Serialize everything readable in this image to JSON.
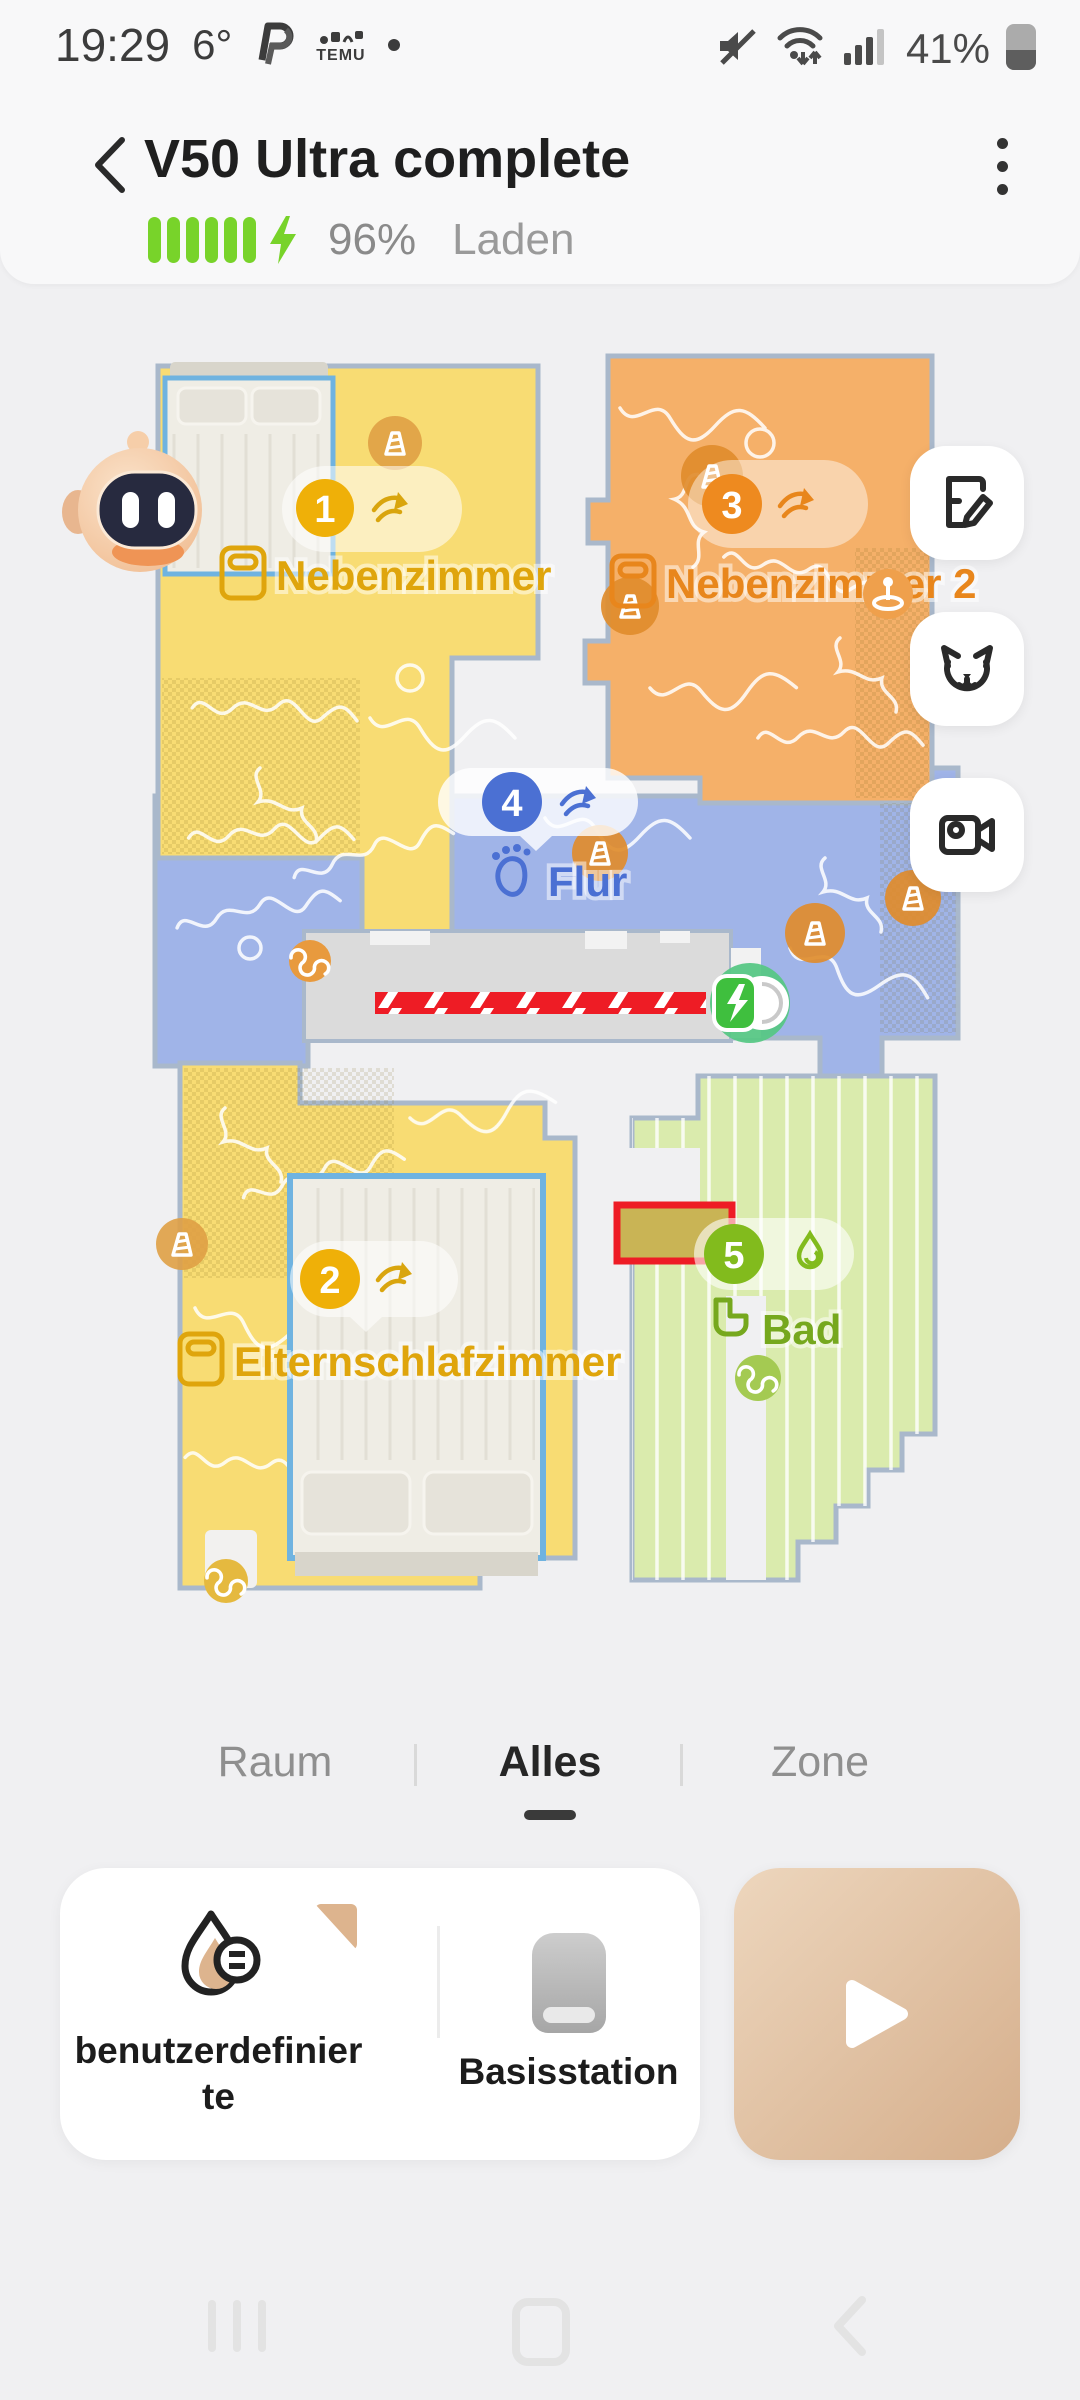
{
  "status_bar": {
    "time": "19:29",
    "temperature": "6°",
    "temu_label": "TEMU",
    "battery_percent": "41%"
  },
  "header": {
    "title": "V50 Ultra complete",
    "battery_percent": "96%",
    "battery_status": "Laden"
  },
  "map": {
    "rooms": [
      {
        "badge": "1",
        "name": "Nebenzimmer",
        "fill": "#F8DC73",
        "badge_color": "#EFB008",
        "label_color": "#DFA50C",
        "action": "sweep"
      },
      {
        "badge": "2",
        "name": "Elternschlafzimmer",
        "fill": "#F8DC73",
        "badge_color": "#EFB008",
        "label_color": "#DFA50C",
        "action": "sweep"
      },
      {
        "badge": "3",
        "name": "Nebenzimmer 2",
        "fill": "#F5B069",
        "badge_color": "#EE8A1F",
        "label_color": "#E8861C",
        "action": "sweep"
      },
      {
        "badge": "4",
        "name": "Flur",
        "fill": "#A0B4E8",
        "badge_color": "#4B70D3",
        "label_color": "#4B70D3",
        "action": "sweep"
      },
      {
        "badge": "5",
        "name": "Bad",
        "fill": "#DAEBAD",
        "badge_color": "#82BB1D",
        "label_color": "#76A81E",
        "action": "mop"
      }
    ],
    "markers": {
      "no_go_zone_color": "#EE1C25",
      "virtual_wall_color": "#EE1C25",
      "dock": "charging-dock"
    }
  },
  "tabs": {
    "items": [
      "Raum",
      "Alles",
      "Zone"
    ],
    "active": "Alles"
  },
  "actions": {
    "custom_label": "benutzerdefinierte",
    "base_station_label": "Basisstation"
  },
  "colors": {
    "accent_tan": "#DDB48E",
    "battery_green": "#78D32A"
  }
}
